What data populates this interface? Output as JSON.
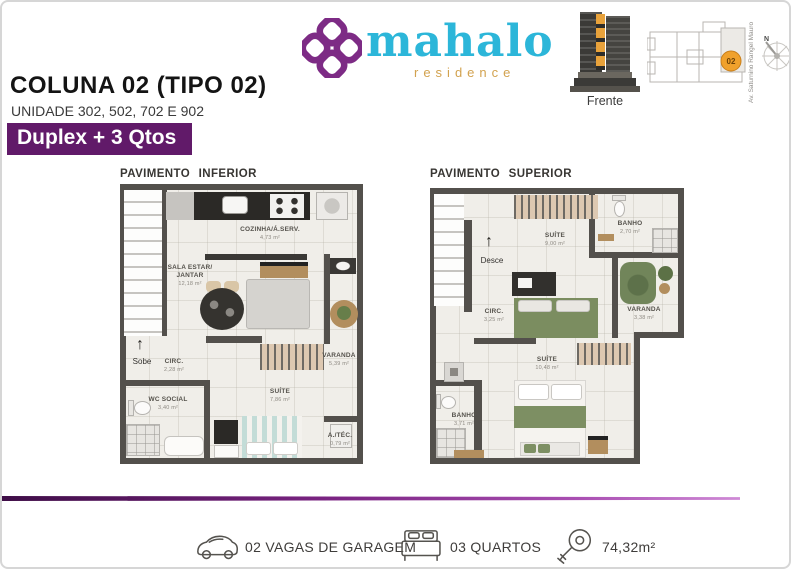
{
  "brand": {
    "wordmark": "mahalo",
    "tagline": "residence",
    "purple": "#7d2b85",
    "cyan": "#2cb6d9",
    "tan": "#d2a24f"
  },
  "header": {
    "title": "COLUNA 02 (TIPO 02)",
    "subtitle": "UNIDADE 302, 502, 702 E 902",
    "badge": "Duplex + 3 Qtos",
    "badge_bg": "#611a69"
  },
  "locator": {
    "front_label": "Frente",
    "street_label": "Av. Saturnino Rangel Mauro",
    "unit_marker": "02",
    "marker_color": "#f0a12c",
    "compass_label": "N"
  },
  "plans": [
    {
      "title": "PAVIMENTO INFERIOR",
      "stairs_label": "Sobe",
      "rooms": [
        {
          "label": "COZINHA/Á.SERV.",
          "area": "4,73 m²"
        },
        {
          "label": "SALA ESTAR/ JANTAR",
          "area": "12,18 m²"
        },
        {
          "label": "CIRC.",
          "area": "2,28 m²"
        },
        {
          "label": "WC SOCIAL",
          "area": "3,40 m²"
        },
        {
          "label": "SUÍTE",
          "area": "7,86 m²"
        },
        {
          "label": "VARANDA",
          "area": "5,39 m²"
        },
        {
          "label": "A./TÉC.",
          "area": "0,79 m²"
        }
      ]
    },
    {
      "title": "PAVIMENTO SUPERIOR",
      "stairs_label": "Desce",
      "rooms": [
        {
          "label": "SUÍTE",
          "area": "9,00 m²"
        },
        {
          "label": "BANHO",
          "area": "2,70 m²"
        },
        {
          "label": "CIRC.",
          "area": "3,25 m²"
        },
        {
          "label": "VARANDA",
          "area": "3,38 m²"
        },
        {
          "label": "SUÍTE",
          "area": "10,48 m²"
        },
        {
          "label": "BANHO",
          "area": "3,71 m²"
        }
      ]
    }
  ],
  "footer": {
    "garage": "02 VAGAS DE GARAGEM",
    "bedrooms": "03 QUARTOS",
    "total_area": "74,32m²"
  }
}
